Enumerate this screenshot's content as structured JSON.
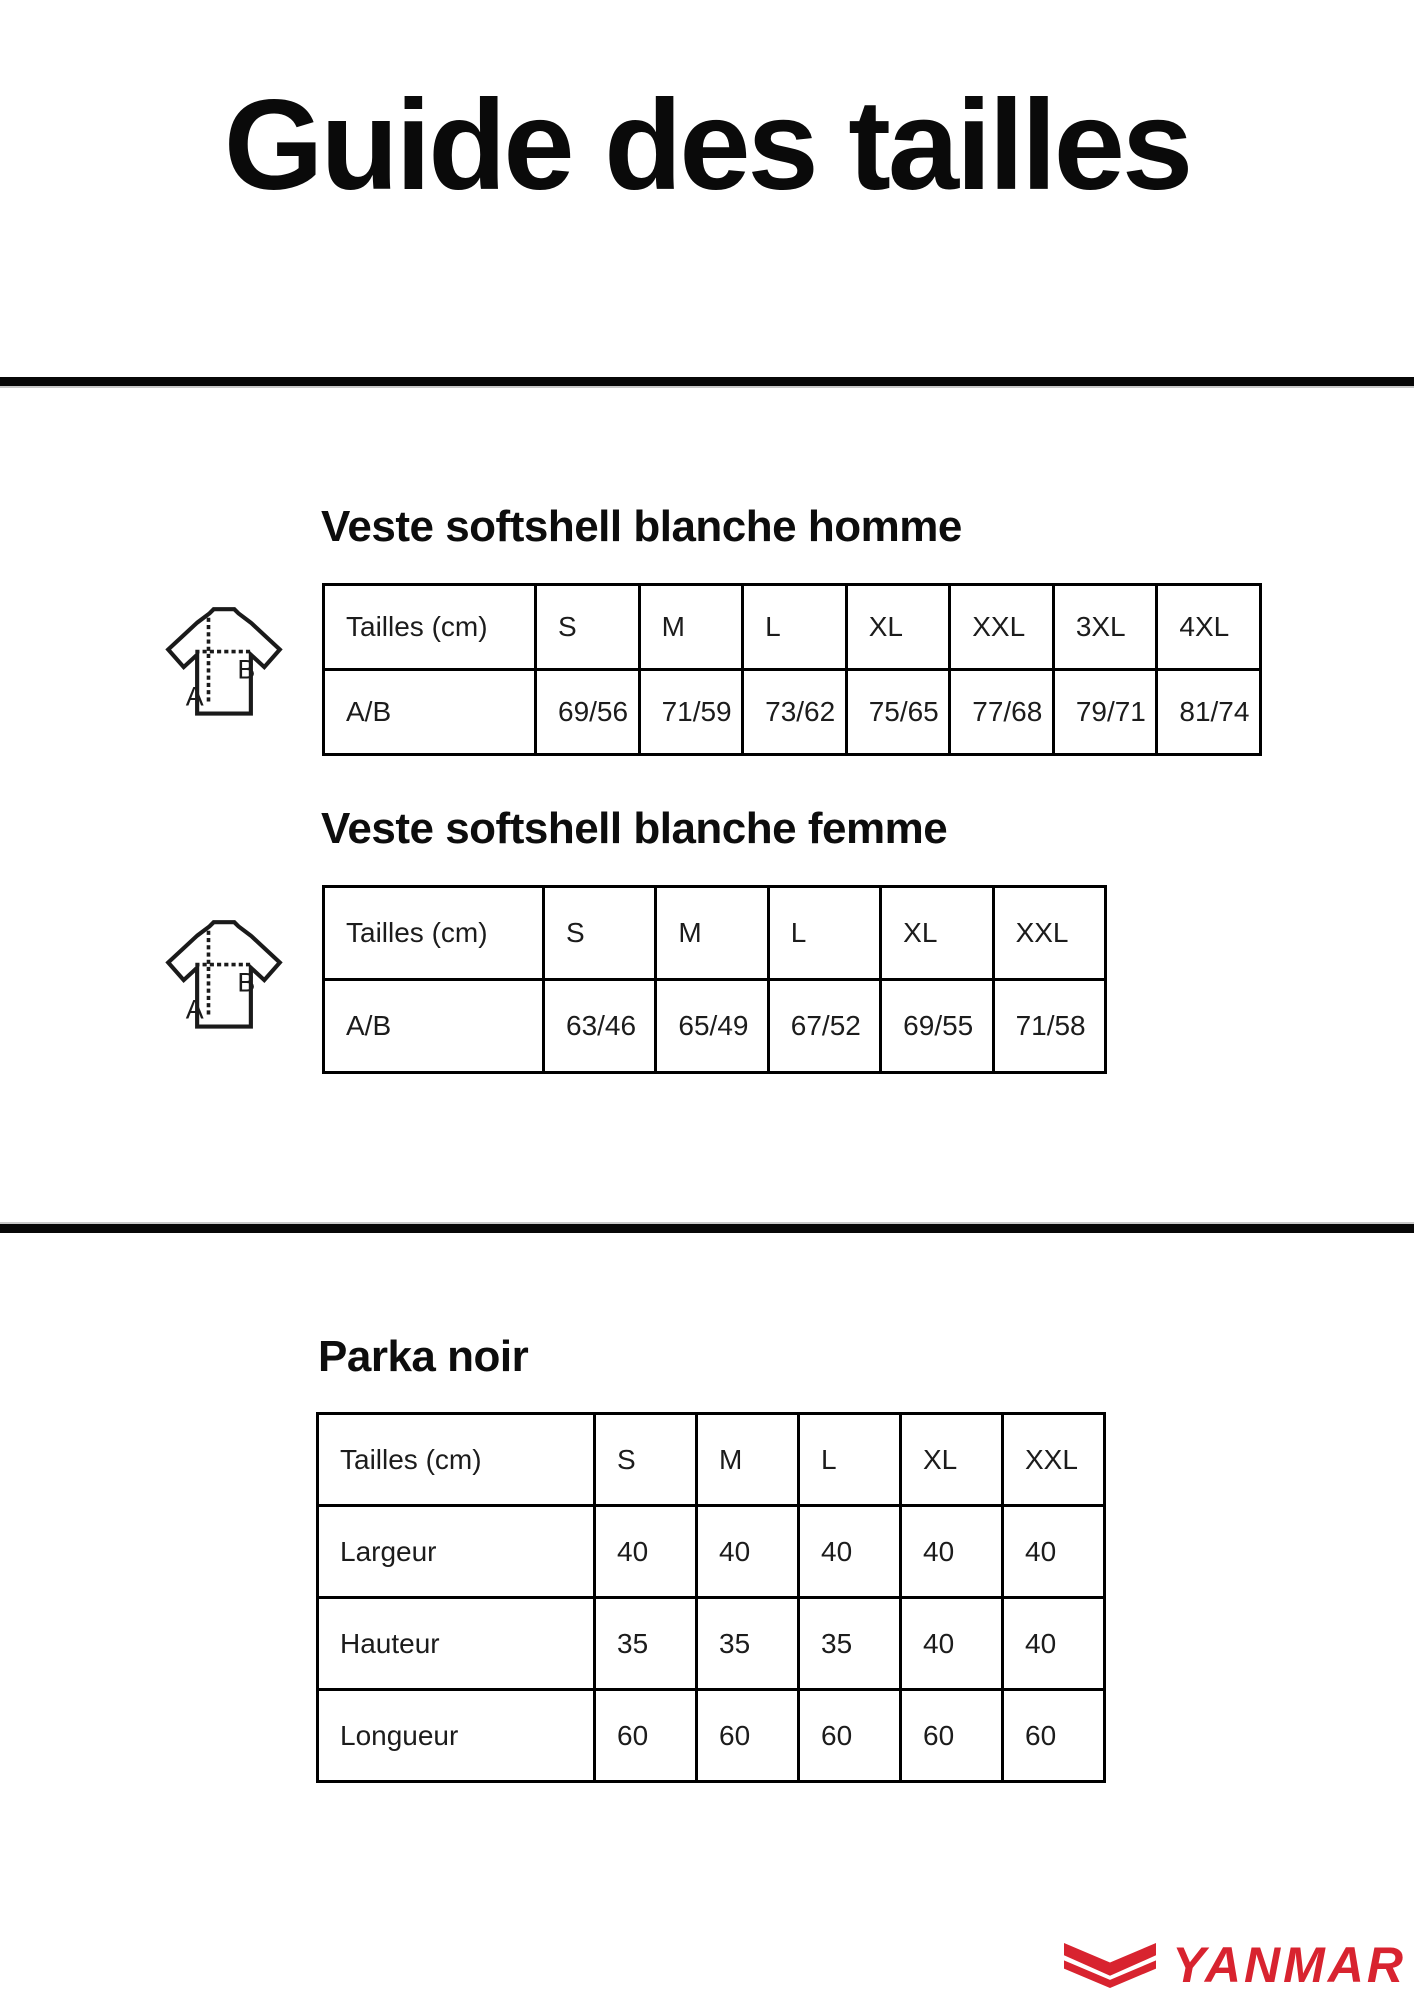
{
  "page": {
    "title": "Guide des tailles"
  },
  "sections": [
    {
      "heading": "Veste softshell blanche homme",
      "table": {
        "header": [
          "Tailles (cm)",
          "S",
          "M",
          "L",
          "XL",
          "XXL",
          "3XL",
          "4XL"
        ],
        "rows": [
          [
            "A/B",
            "69/56",
            "71/59",
            "73/62",
            "75/65",
            "77/68",
            "79/71",
            "81/74"
          ]
        ]
      }
    },
    {
      "heading": "Veste softshell blanche femme",
      "table": {
        "header": [
          "Tailles (cm)",
          "S",
          "M",
          "L",
          "XL",
          "XXL"
        ],
        "rows": [
          [
            "A/B",
            "63/46",
            "65/49",
            "67/52",
            "69/55",
            "71/58"
          ]
        ]
      }
    },
    {
      "heading": "Parka noir",
      "table": {
        "header": [
          "Tailles (cm)",
          "S",
          "M",
          "L",
          "XL",
          "XXL"
        ],
        "rows": [
          [
            "Largeur",
            "40",
            "40",
            "40",
            "40",
            "40"
          ],
          [
            "Hauteur",
            "35",
            "35",
            "35",
            "40",
            "40"
          ],
          [
            "Longueur",
            "60",
            "60",
            "60",
            "60",
            "60"
          ]
        ]
      }
    }
  ],
  "measure_icon": {
    "length_label": "A",
    "width_label": "B"
  },
  "brand": {
    "wordmark": "YANMAR",
    "color": "#d8232f",
    "icon": "yanmar-double-chevron"
  }
}
